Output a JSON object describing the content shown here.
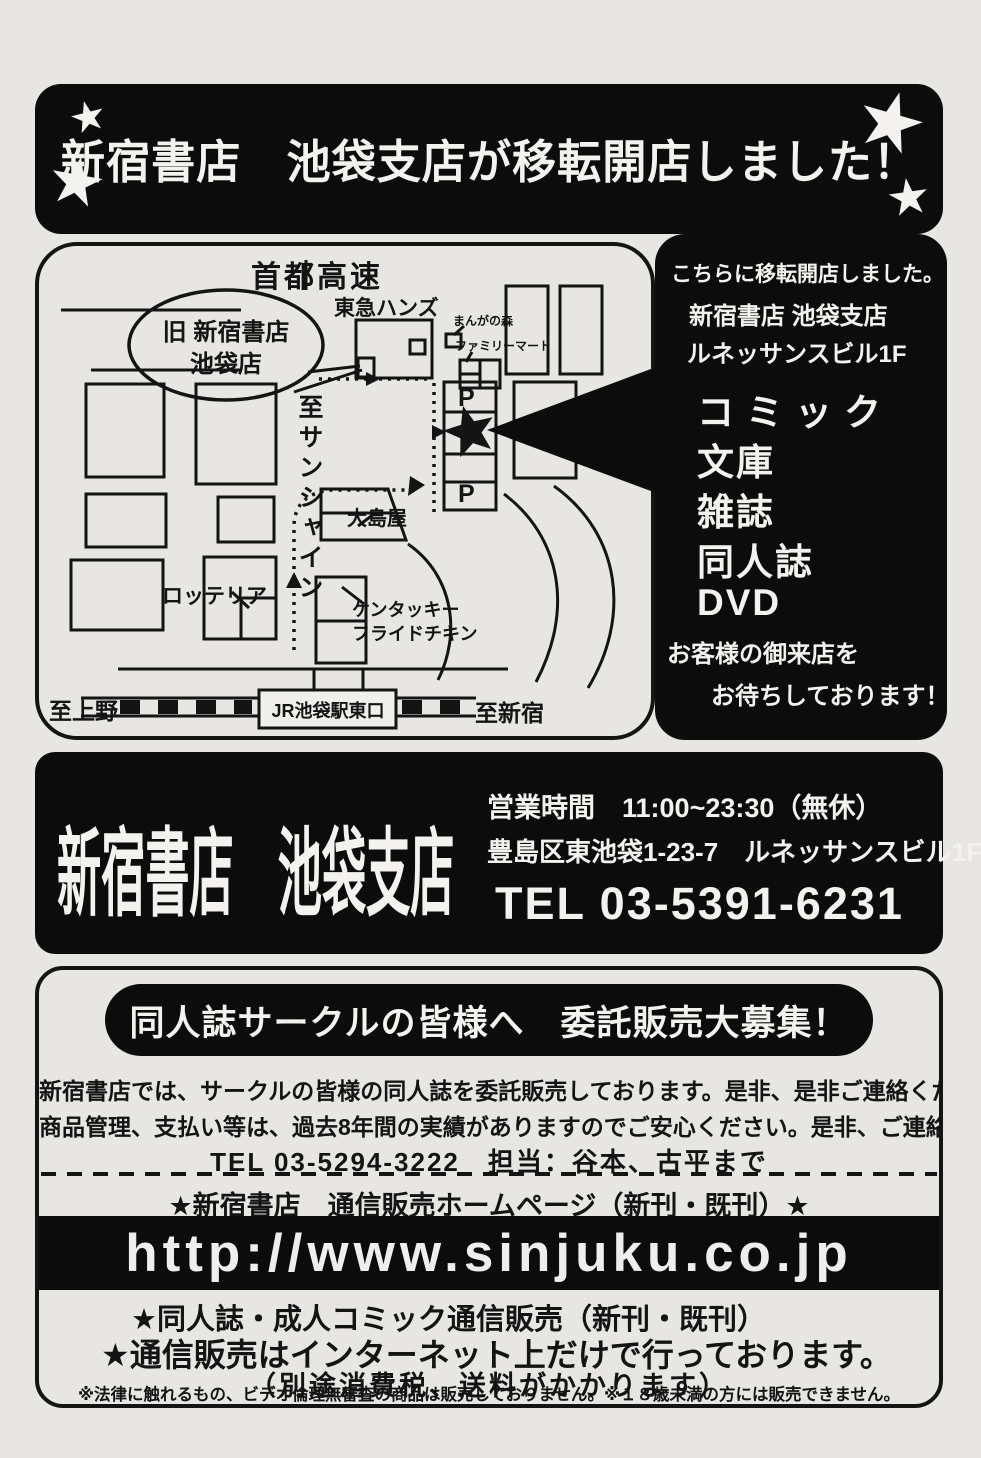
{
  "top_banner": {
    "title": "新宿書店　池袋支店が移転開店しました！",
    "star_icon": "★"
  },
  "map": {
    "labels": {
      "expressway": "首都高速",
      "old_store_line1": "旧 新宿書店",
      "old_store_line2": "池袋店",
      "tokyu_hands": "東急ハンズ",
      "manga_no_mori": "まんがの森",
      "family_mart": "ファミリーマート",
      "to_sunshine": "至サンシャイン",
      "parking": "P",
      "oshimaya": "大島屋",
      "lotteria": "ロッテリア",
      "kfc_line1": "ケンタッキー",
      "kfc_line2": "フライドチキン",
      "to_ueno": "至上野",
      "station": "JR池袋駅東口",
      "to_shinjuku": "至新宿"
    }
  },
  "right_panel": {
    "moved_here": "こちらに移転開店しました。",
    "store_name": "新宿書店 池袋支店",
    "building": "ルネッサンスビル1F",
    "items": [
      "コミック",
      "文庫",
      "雑誌",
      "同人誌",
      "DVD"
    ],
    "welcome_line1": "お客様の御来店を",
    "welcome_line2": "お待ちしております！"
  },
  "info_band": {
    "store_name": "新宿書店　池袋支店",
    "hours": "営業時間　11:00~23:30（無休）",
    "address": "豊島区東池袋1-23-7　ルネッサンスビル1F",
    "tel": "TEL 03-5391-6231"
  },
  "recruit": {
    "banner": "同人誌サークルの皆様へ　委託販売大募集！",
    "body1": "新宿書店では、サークルの皆様の同人誌を委託販売しております。是非、是非ご連絡ください。",
    "body2": "商品管理、支払い等は、過去8年間の実績がありますのでご安心ください。是非、ご連絡ください。",
    "tel_line": "TEL 03-5294-3222　担当：谷本、古平まで",
    "homepage_line": "★新宿書店　通信販売ホームページ（新刊・既刊）★",
    "url": "http://www.sinjuku.co.jp",
    "mail_order1": "★同人誌・成人コミック通信販売（新刊・既刊）",
    "mail_order2": "★通信販売はインターネット上だけで行っております。",
    "mail_order3": "（別途消費税、送料がかかります）",
    "fine_print": "※法律に触れるもの、ビデオ倫理無審査の商品は販売しておりません。※１８歳未満の方には販売できません。"
  }
}
